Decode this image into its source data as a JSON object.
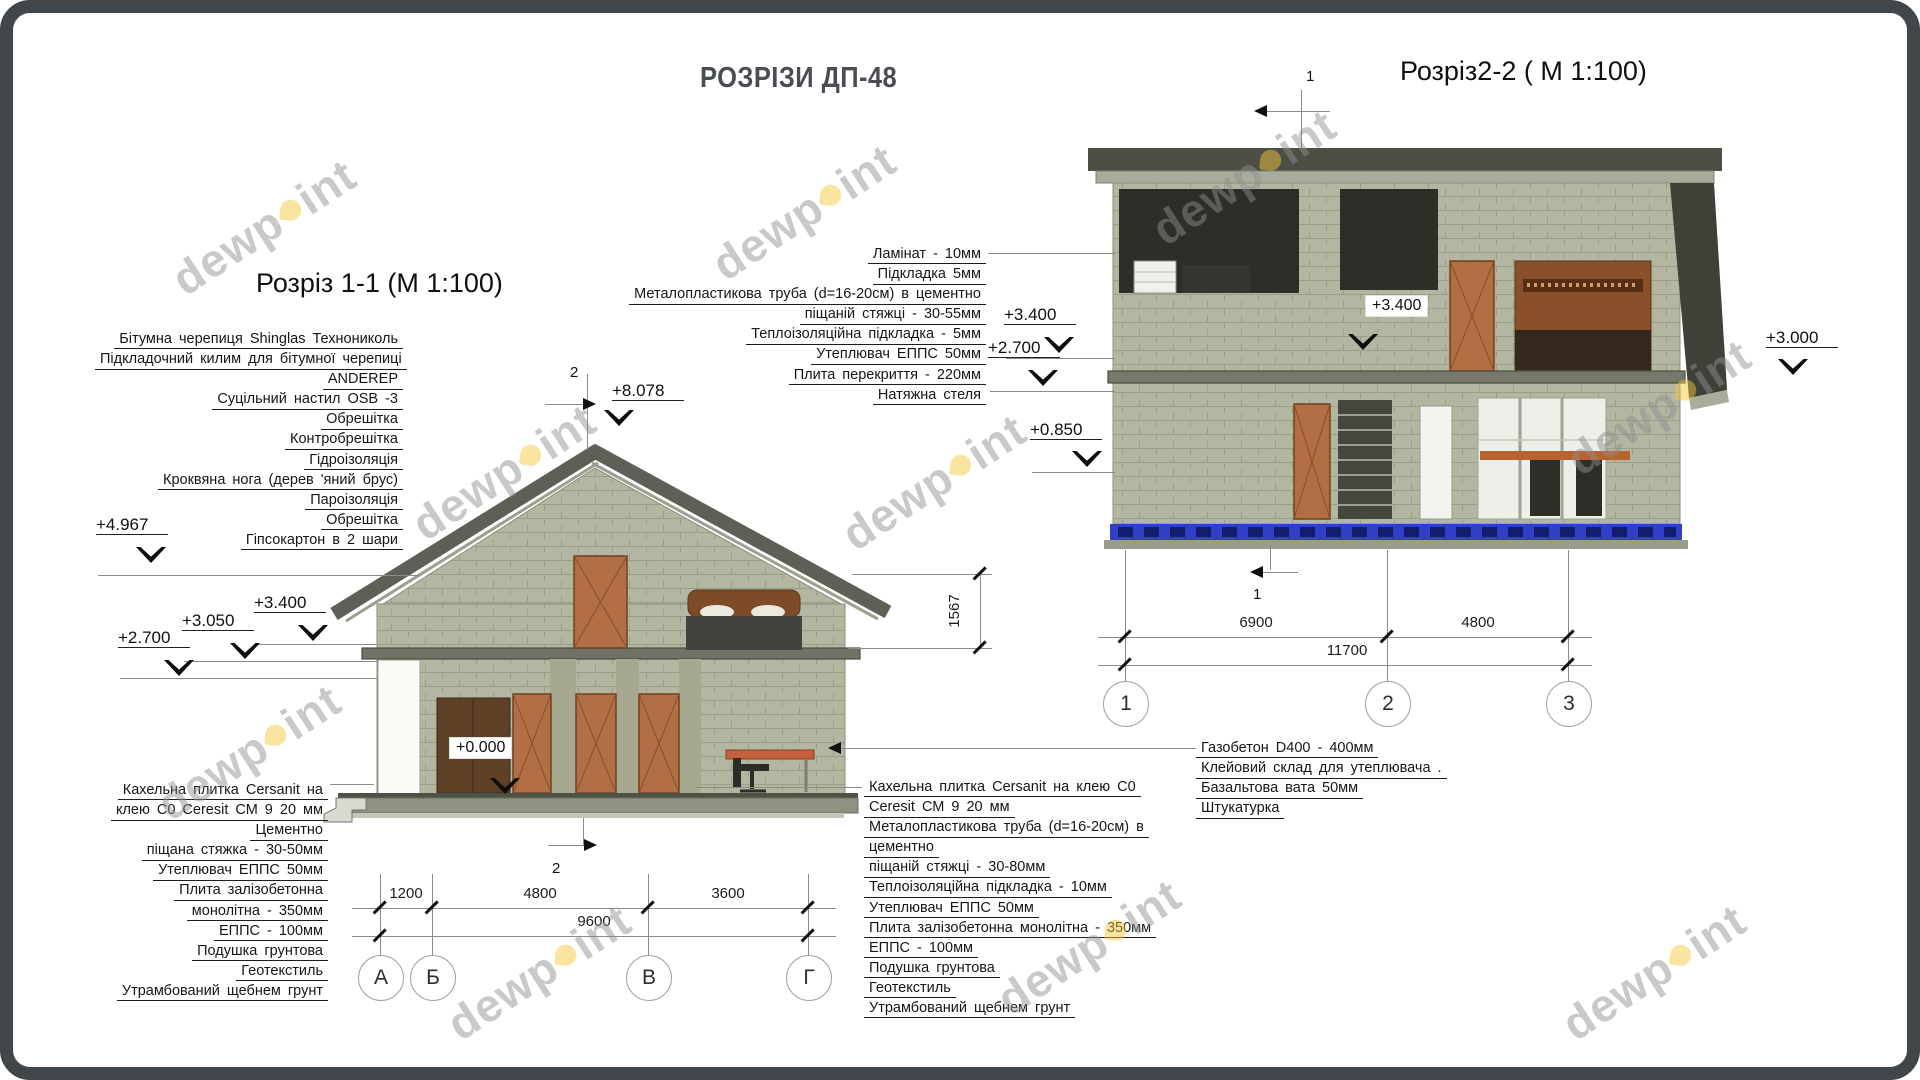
{
  "header": {
    "title": "РОЗРІЗИ ДП-48"
  },
  "watermark": {
    "left": "dewp",
    "right": "int"
  },
  "colors": {
    "foundation_blue": "#2f40c4",
    "watermark_yellow": "#f3c73a",
    "wall_sage": "#b3b6a1",
    "roof_dark": "#4c4f45"
  },
  "section1": {
    "title": "Розріз 1-1 (М 1:100)",
    "cut_label": "2",
    "elev": {
      "peak": "+8.078",
      "l1": "+4.967",
      "l2": "+3.400",
      "l3": "+3.050",
      "l4": "+2.700",
      "zero": "+0.000"
    },
    "roof_layers": [
      "Бітумна  черепиця Shinglas Технониколь",
      "Підкладочний килим для бітумної черепиці",
      "ANDEREP",
      "Суцільний настил  OSB -3",
      "Обрешітка",
      "Контробрешітка",
      "Гідроізоляція",
      "Кроквяна нога (дерев 'яний брус)",
      "Пароізоляція",
      "Обрешітка",
      "Гіпсокартон  в 2 шари"
    ],
    "floor_layers": [
      "Кахельна плитка  Cersanit на",
      "клею C0 Ceresit СМ 9 20   мм",
      "Цементно",
      "піщана стяжка  - 30-50мм",
      "Утеплювач   ЕППС  50мм",
      "Плита  залізобетонна",
      "монолітна  - 350мм",
      "ЕППС  - 100мм",
      "Подушка грунтова",
      "Геотекстиль",
      "Утрамбований  щебнем грунт"
    ],
    "dims": {
      "d1": "1200",
      "d2": "4800",
      "d3": "3600",
      "total": "9600",
      "eave": "1567"
    },
    "axes": [
      "А",
      "Б",
      "В",
      "Г"
    ]
  },
  "section2": {
    "title": "Розріз2-2 ( М 1:100)",
    "cut_label": "1",
    "elev": {
      "l1": "+3.400",
      "l2": "+2.700",
      "l3": "+0.850",
      "inner": "+3.400",
      "right": "+3.000"
    },
    "ceiling_layers": [
      "Ламінат   - 10мм",
      "Підкладка 5мм",
      "Металопластикова   труба  (d=16-20см) в цементно",
      "піщаній стяжці  - 30-55мм",
      "Теплоізоляційна підкладка - 5мм",
      "Утеплювач  ЕППС  50мм",
      "Плита  перекриття   - 220мм",
      "Натяжна  стеля"
    ],
    "floor_layers": [
      "Кахельна плитка  Cersanit на клею C0",
      "Ceresit СМ 9 20   мм",
      "Металопластикова   труба  (d=16-20см) в",
      "цементно",
      "піщаній стяжці  - 30-80мм",
      "Теплоізоляційна підкладка - 10мм",
      "Утеплювач  ЕППС  50мм",
      "Плита залізобетонна  монолітна  - 350мм",
      "ЕППС  - 100мм",
      "Подушка грунтова",
      "Геотекстиль",
      "Утрамбований  щебнем грунт"
    ],
    "wall_layers": [
      "Газобетон   D400 - 400мм",
      "Клейовий склад для утеплювача  .",
      "Базальтова  вата  50мм",
      "Штукатурка"
    ],
    "dims": {
      "d1": "6900",
      "d2": "4800",
      "total": "11700"
    },
    "axes": [
      "1",
      "2",
      "3"
    ]
  }
}
